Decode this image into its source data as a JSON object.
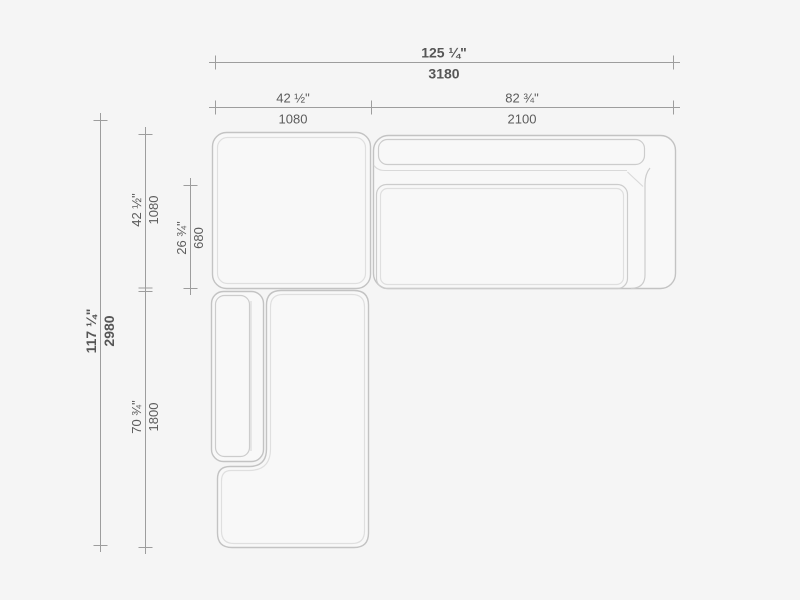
{
  "colors": {
    "background": "#f5f5f5",
    "furniture_outline": "#c3c3c3",
    "furniture_highlight": "#dfdfdf",
    "dimension_line": "#9d9d9d",
    "dimension_text": "#5c5c5c"
  },
  "dimensions": {
    "overall_width": {
      "inches": "125 ¼\"",
      "mm": "3180"
    },
    "corner_width": {
      "inches": "42 ½\"",
      "mm": "1080"
    },
    "lounge_width": {
      "inches": "82 ¾\"",
      "mm": "2100"
    },
    "overall_depth": {
      "inches": "117 ¼\"",
      "mm": "2980"
    },
    "corner_depth": {
      "inches": "42 ½\"",
      "mm": "1080"
    },
    "seat_depth": {
      "inches": "26 ¾\"",
      "mm": "680"
    },
    "chaise_depth": {
      "inches": "70 ¾\"",
      "mm": "1800"
    }
  }
}
